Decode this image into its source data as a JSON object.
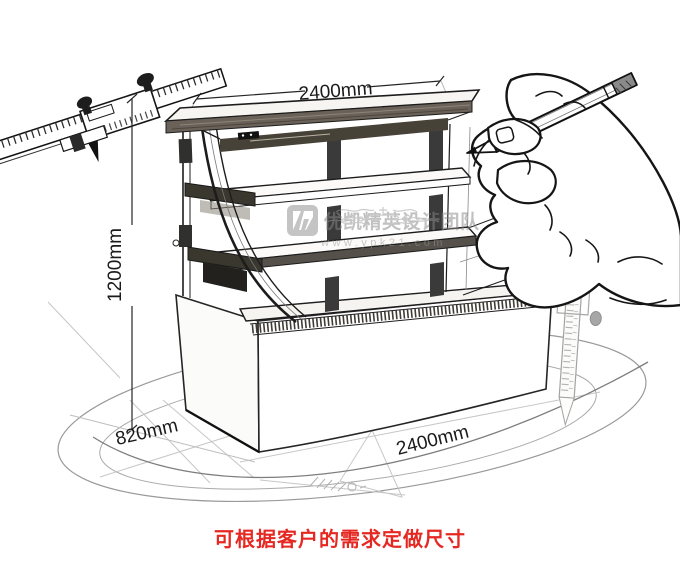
{
  "dimensions": {
    "top_width": "2400mm",
    "height": "1200mm",
    "depth": "820mm",
    "bottom_width": "2400mm"
  },
  "watermark": {
    "brand": "优凯精英设计团队",
    "site": "www.ypk21.com"
  },
  "note": {
    "text": "可根据客户的需求定做尺寸"
  },
  "sketch_elements": [
    "vernier-caliper",
    "curved-glass-cake-display-cabinet",
    "hand-holding-pencil",
    "height-gauge",
    "rotation-ellipses"
  ],
  "colors": {
    "line": "#1f1f1f",
    "faint": "#c7c7c7",
    "swoosh": "#8f8f8f",
    "watermark_gray": "#8f8f8f",
    "note_red": "#e62823"
  }
}
